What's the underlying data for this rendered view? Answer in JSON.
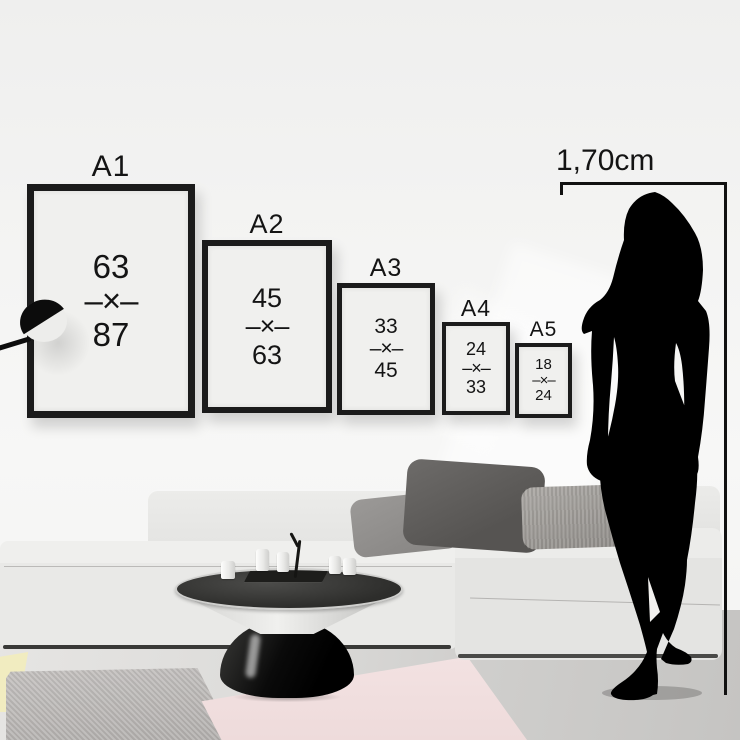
{
  "scene": {
    "height_label": "1,70cm",
    "frames": [
      {
        "label": "A1",
        "top_value": "63",
        "separator": "–×–",
        "bottom_value": "87"
      },
      {
        "label": "A2",
        "top_value": "45",
        "separator": "–×–",
        "bottom_value": "63"
      },
      {
        "label": "A3",
        "top_value": "33",
        "separator": "–×–",
        "bottom_value": "45"
      },
      {
        "label": "A4",
        "top_value": "24",
        "separator": "–×–",
        "bottom_value": "33"
      },
      {
        "label": "A5",
        "top_value": "18",
        "separator": "–×–",
        "bottom_value": "24"
      }
    ]
  },
  "colors": {
    "ink": "#141414",
    "frame_black": "#1b1b1b",
    "line_black": "#111111",
    "paper": "#f0f0ee",
    "sofa": "#e9e9e7",
    "rug_yellow": "#f1ecc0",
    "silhouette": "#000000"
  }
}
